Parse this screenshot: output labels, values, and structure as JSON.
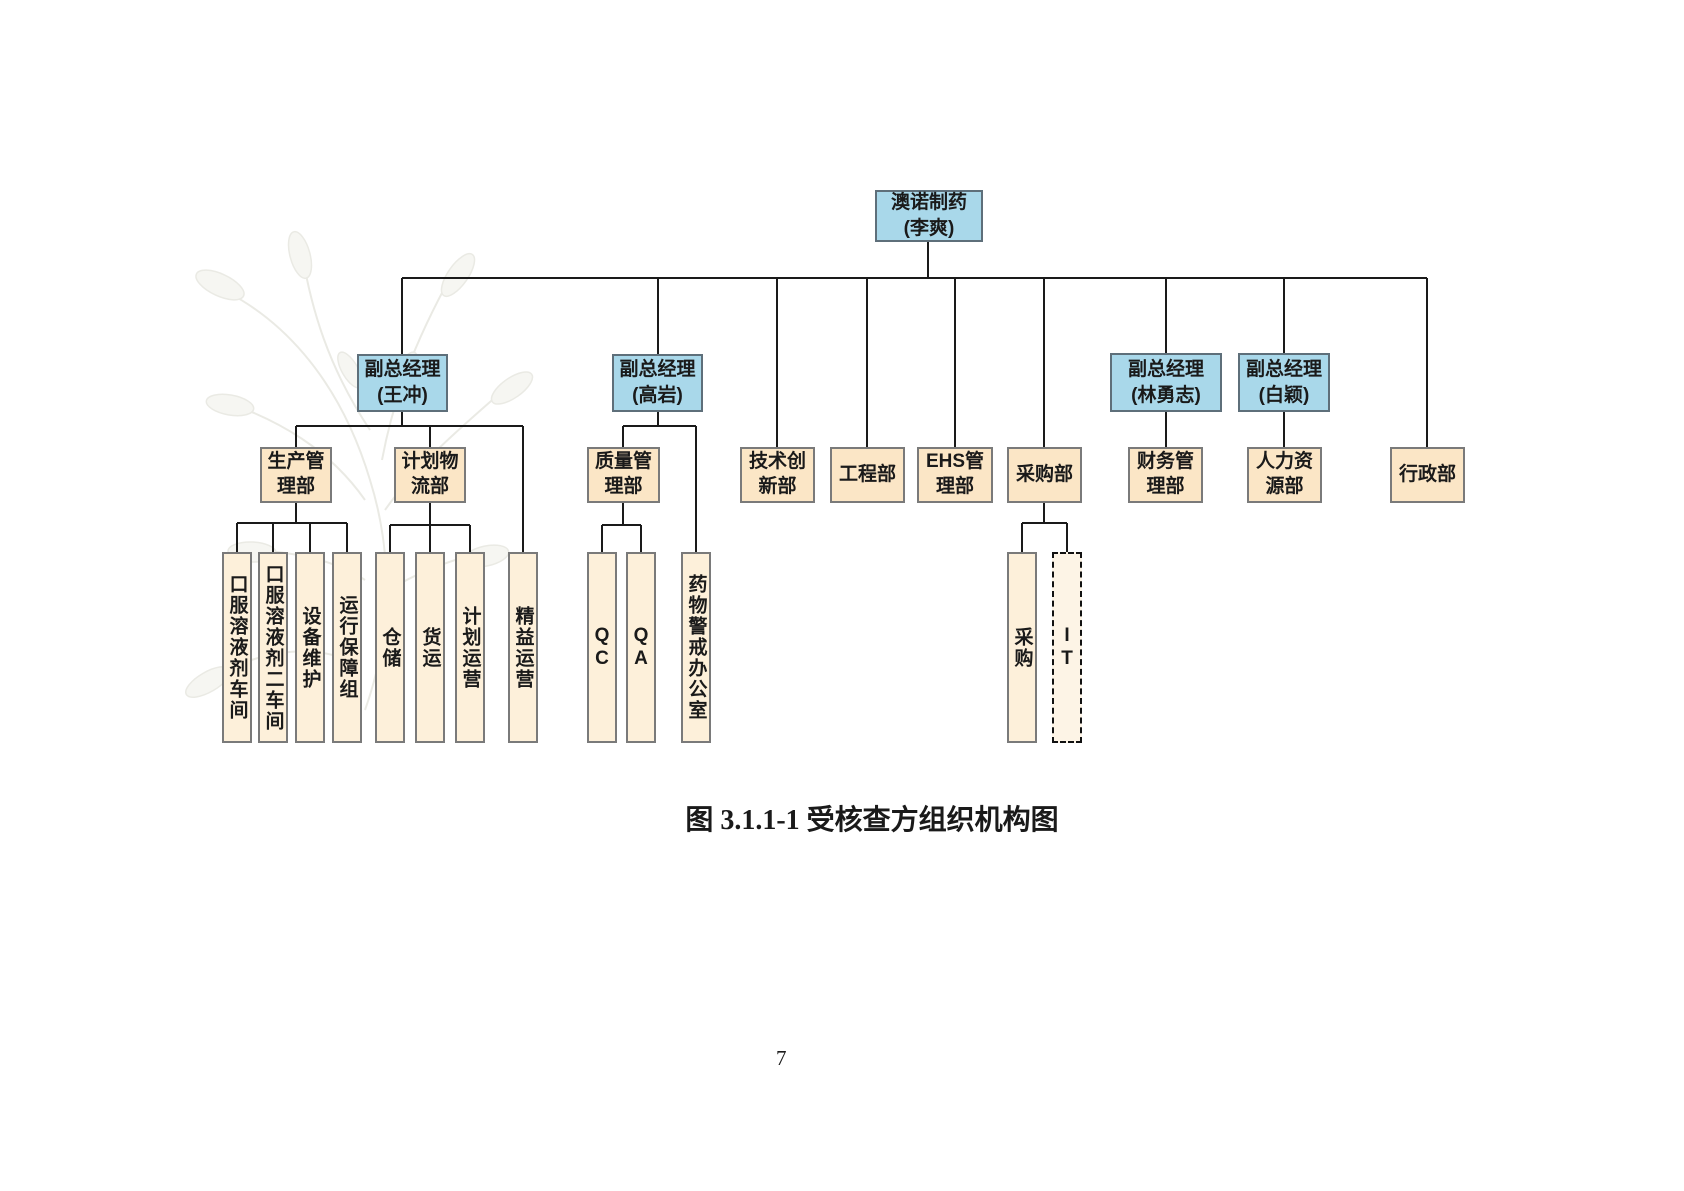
{
  "page": {
    "caption": "图 3.1.1-1  受核查方组织机构图",
    "page_number": "7"
  },
  "colors": {
    "executive_fill": "#a9d8ea",
    "department_fill": "#fbe6c6",
    "unit_fill": "#fdf0da",
    "it_fill": "#fdf4e6",
    "box_border": "#7a7a7a",
    "line": "#1a1a1a"
  },
  "chart": {
    "root": {
      "title": "澳诺制药",
      "name": "(李爽)"
    },
    "executives": [
      {
        "title": "副总经理",
        "name": "(王冲)"
      },
      {
        "title": "副总经理",
        "name": "(高岩)"
      },
      {
        "title": "副总经理",
        "name": "(林勇志)"
      },
      {
        "title": "副总经理",
        "name": "(白颖)"
      }
    ],
    "departments": [
      {
        "label": "生产管理部"
      },
      {
        "label": "计划物流部"
      },
      {
        "label": "质量管理部"
      },
      {
        "label": "技术创新部"
      },
      {
        "label": "工程部"
      },
      {
        "label": "EHS管理部"
      },
      {
        "label": "采购部"
      },
      {
        "label": "财务管理部"
      },
      {
        "label": "人力资源部"
      },
      {
        "label": "行政部"
      }
    ],
    "units": [
      {
        "label": "口服溶液剂车间"
      },
      {
        "label": "口服溶液剂二车间"
      },
      {
        "label": "设备维护"
      },
      {
        "label": "运行保障组"
      },
      {
        "label": "仓储"
      },
      {
        "label": "货运"
      },
      {
        "label": "计划运营"
      },
      {
        "label": "精益运营"
      },
      {
        "label": "QC"
      },
      {
        "label": "QA"
      },
      {
        "label": "药物警戒办公室"
      },
      {
        "label": "采购"
      },
      {
        "label": "IT"
      }
    ]
  }
}
